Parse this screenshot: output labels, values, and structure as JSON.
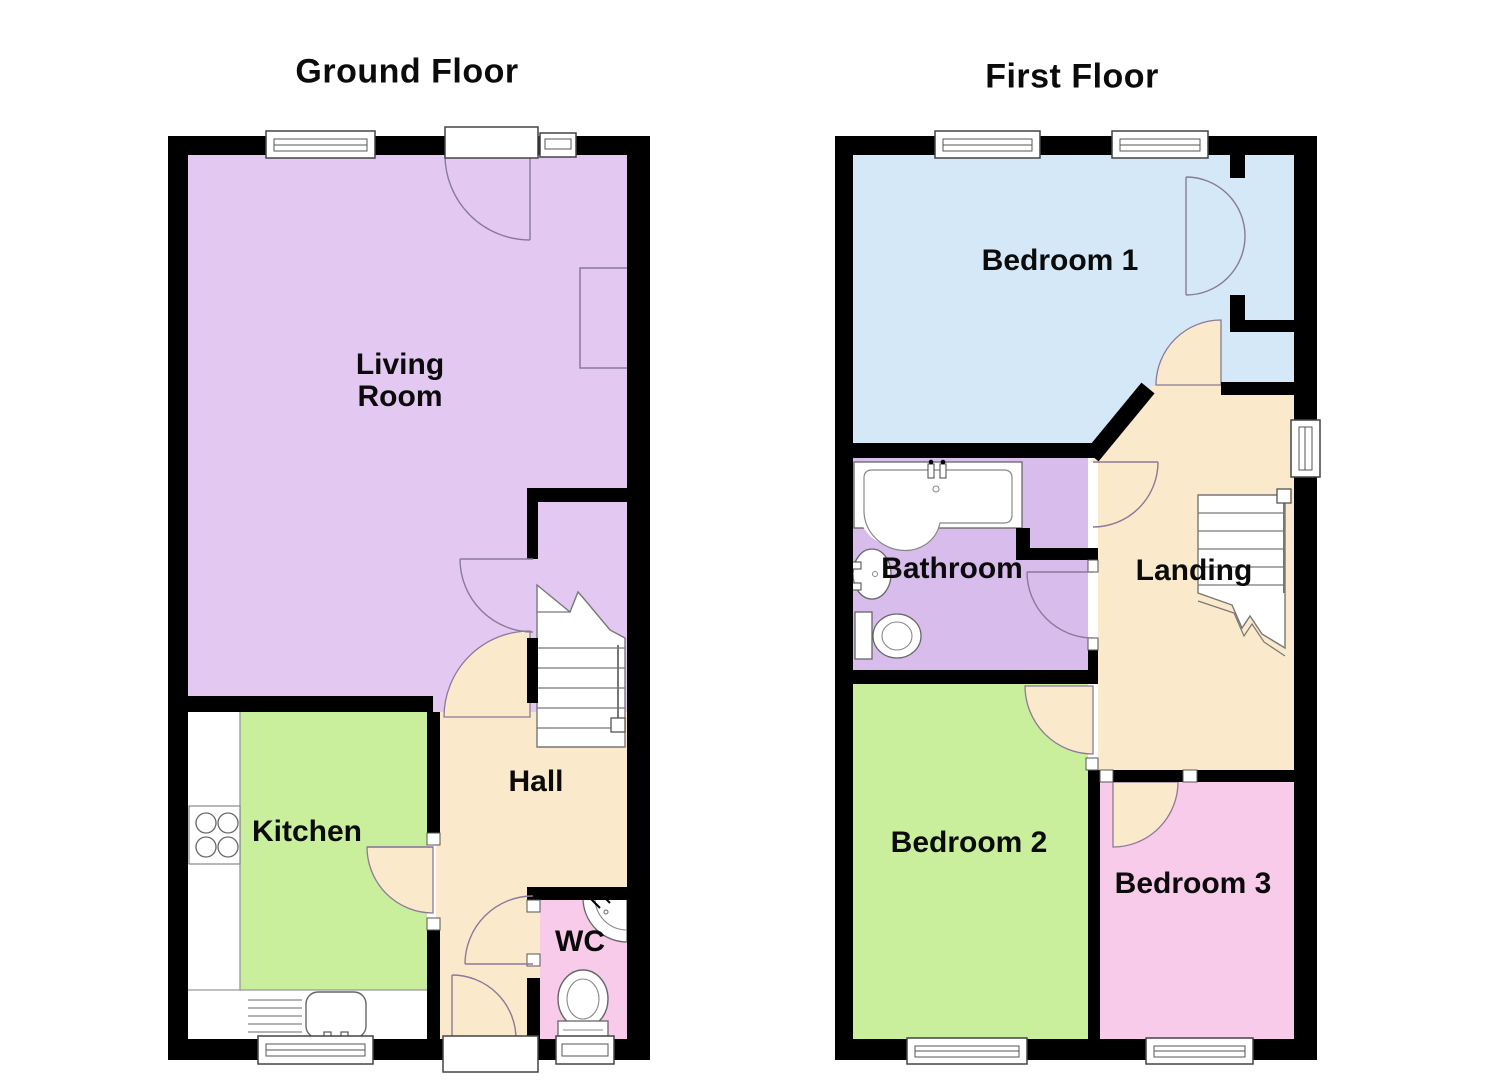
{
  "titles": {
    "ground": "Ground Floor",
    "first": "First Floor"
  },
  "rooms": {
    "living": {
      "label": "Living Room",
      "color": "#E3C9F2"
    },
    "kitchen": {
      "label": "Kitchen",
      "color": "#C9EF9C"
    },
    "hall": {
      "label": "Hall",
      "color": "#FBE9CC"
    },
    "wc": {
      "label": "WC",
      "color": "#F7CBE9"
    },
    "bedroom1": {
      "label": "Bedroom 1",
      "color": "#D4E8F8"
    },
    "bathroom": {
      "label": "Bathroom",
      "color": "#D7BCEC"
    },
    "landing": {
      "label": "Landing",
      "color": "#FBE9CC"
    },
    "bedroom2": {
      "label": "Bedroom 2",
      "color": "#C9EF9C"
    },
    "bedroom3": {
      "label": "Bedroom 3",
      "color": "#F7CBE9"
    }
  },
  "colors": {
    "wall": "#000000",
    "background": "#FFFFFF",
    "fixture_stroke": "#666666",
    "door_arc": "#8A7A99"
  }
}
